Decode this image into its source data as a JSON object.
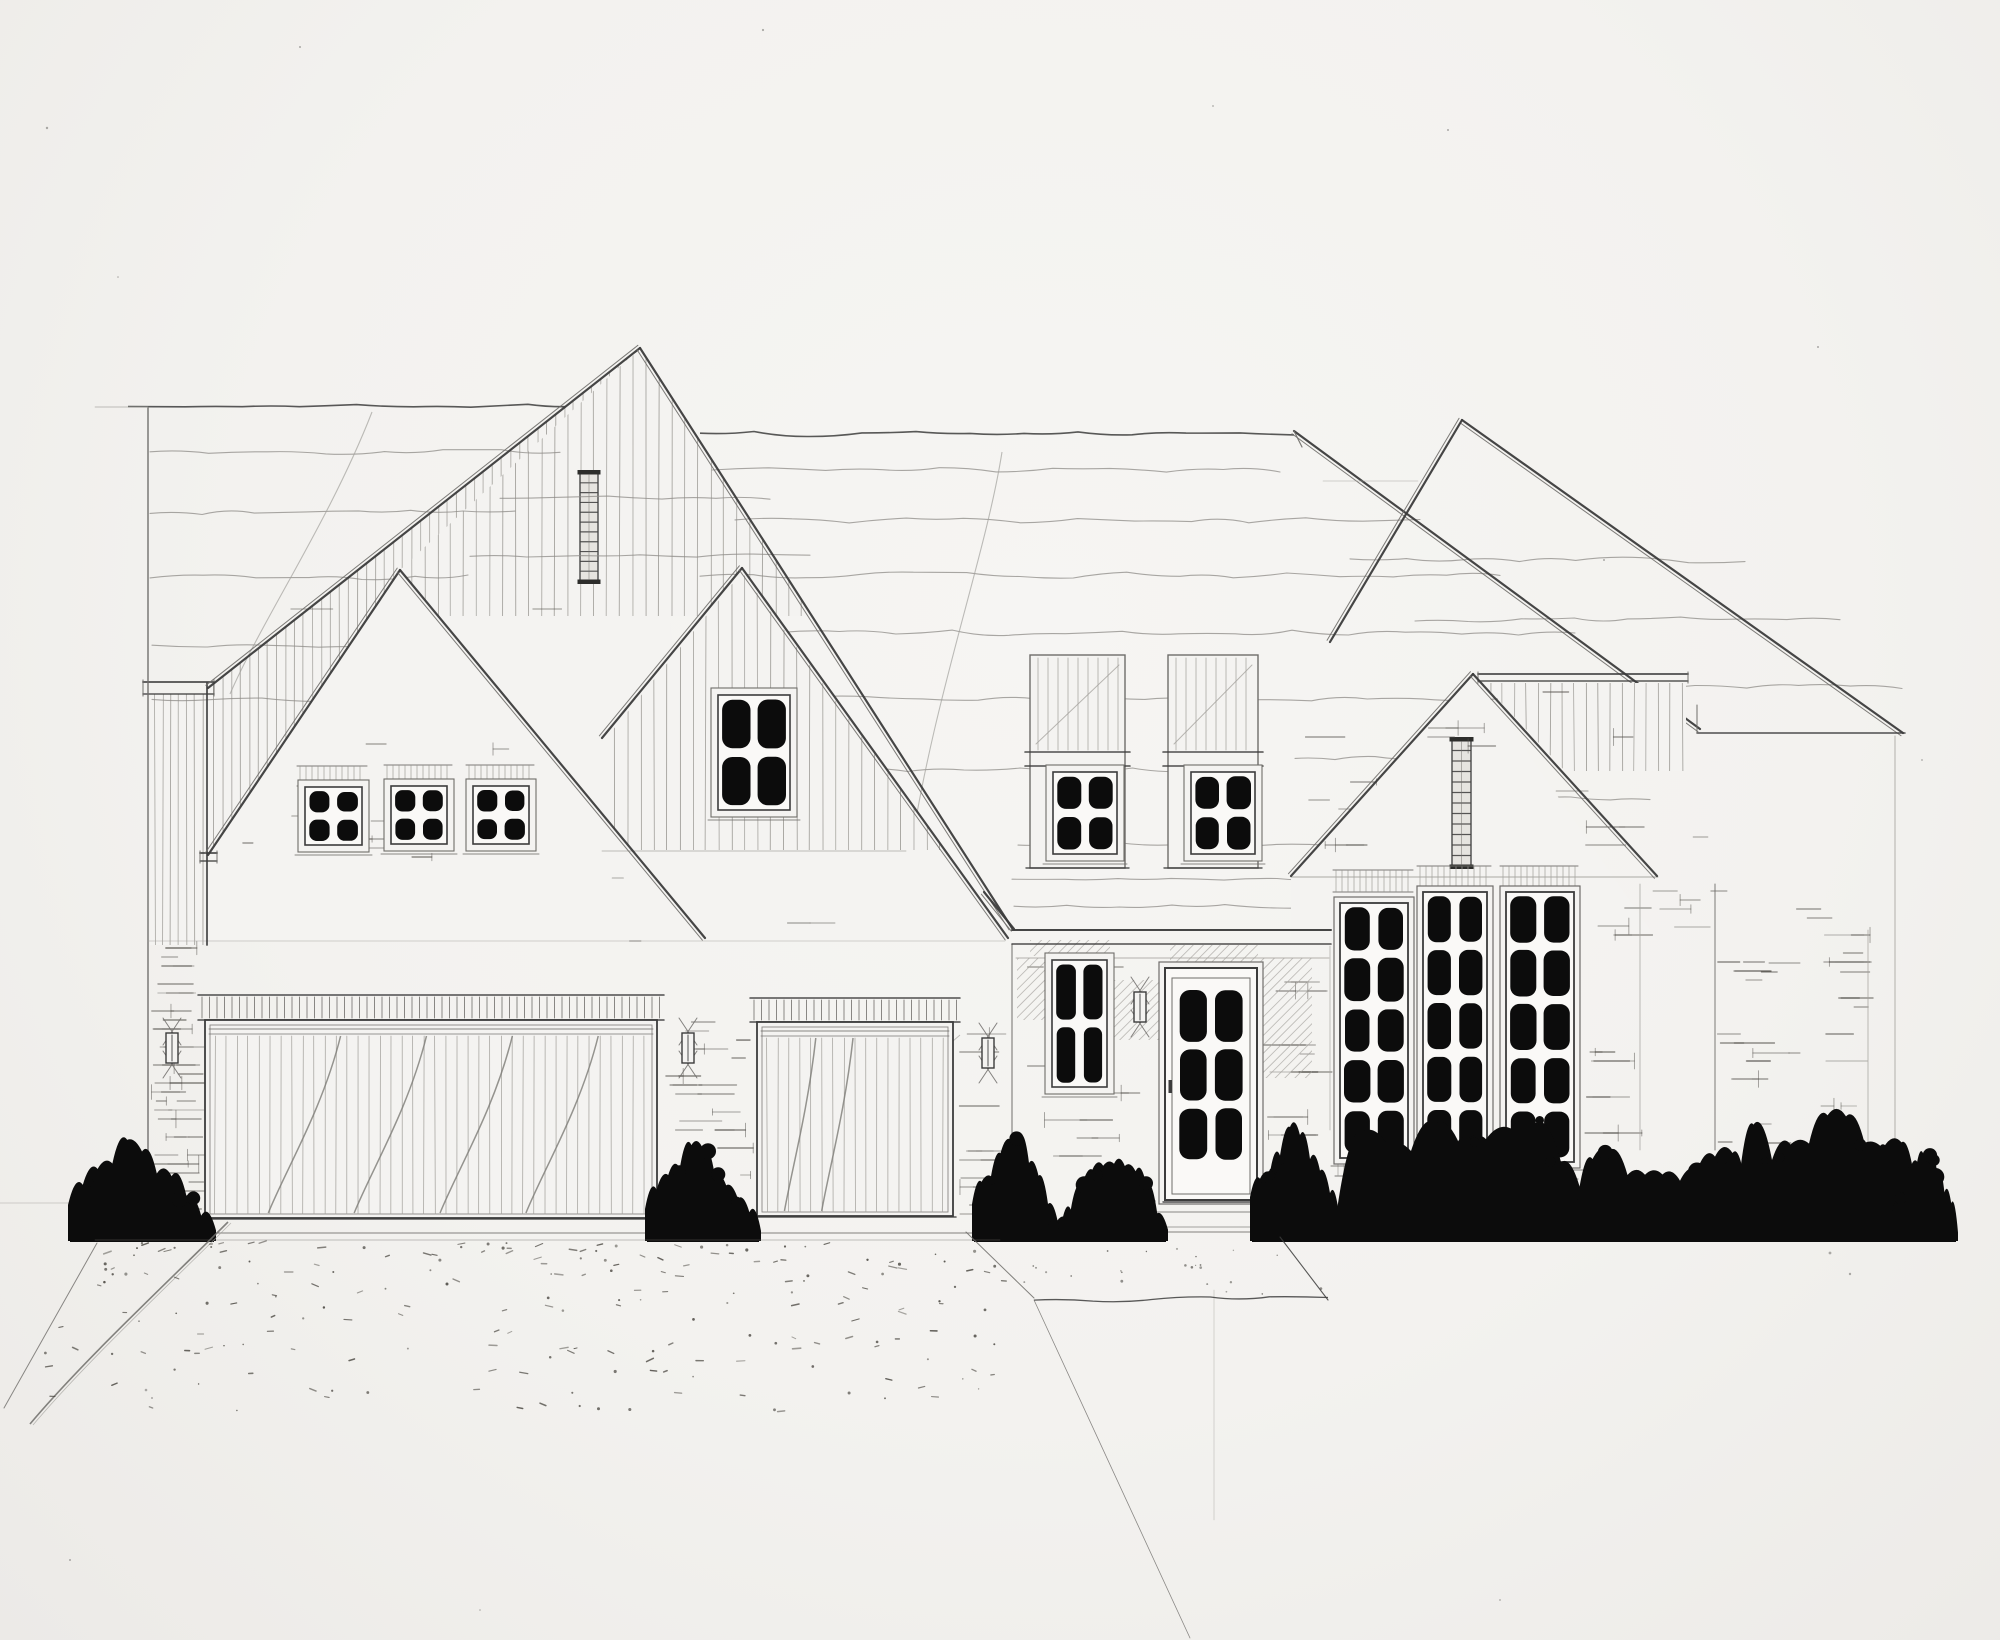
{
  "meta": {
    "kind": "hand-drawn pencil architectural front elevation sketch",
    "subject": "single-family house with overlapping steep gables, three-car garage, recessed entry, tall multi-pane windows, shrub row and stippled driveway",
    "width": 2000,
    "height": 1640
  },
  "palette": {
    "paper": "#f4f3f1",
    "paper_shade": "#eceae7",
    "dark": "#3c3c3c",
    "mid": "#6f6d6a",
    "light": "#a3a19c",
    "wave": "#8d8b87",
    "dash": "#56534e",
    "black": "#0c0c0c",
    "louver_fill": "#e6e4e0",
    "curve_gray": "#7c7a76"
  },
  "scene": {
    "ground": [
      [
        148,
        1233,
        1010,
        1233,
        1.0,
        "m"
      ],
      [
        1010,
        1232,
        1335,
        1232,
        1.0,
        "m"
      ]
    ],
    "ridges": [
      {
        "x1": 128,
        "x2": 585,
        "y": 406,
        "amp": 2
      },
      {
        "x1": 700,
        "x2": 1294,
        "y": 434,
        "amp": 2.5
      }
    ],
    "rakes": [
      [
        640,
        348,
        208,
        688
      ],
      [
        640,
        348,
        1012,
        928
      ],
      [
        742,
        568,
        602,
        738
      ],
      [
        742,
        568,
        1008,
        938
      ],
      [
        400,
        570,
        208,
        855
      ],
      [
        400,
        570,
        705,
        938
      ],
      [
        1473,
        674,
        1291,
        876
      ],
      [
        1473,
        674,
        1657,
        876
      ],
      [
        1294,
        431,
        1700,
        729
      ],
      [
        1462,
        420,
        1903,
        733
      ],
      [
        1462,
        420,
        1330,
        642
      ],
      [
        984,
        892,
        1014,
        929
      ]
    ],
    "edges": [
      [
        148,
        408,
        148,
        1232,
        1.5,
        "m"
      ],
      [
        95,
        407,
        148,
        407,
        0.7,
        "l"
      ],
      [
        148,
        941,
        1005,
        941,
        0.5,
        "l"
      ],
      [
        1697,
        733,
        1905,
        733,
        1.5,
        "d"
      ],
      [
        1895,
        736,
        1895,
        1208,
        0.9,
        "l"
      ],
      [
        1697,
        705,
        1697,
        733,
        1.1,
        "m"
      ],
      [
        1291,
        877,
        1658,
        877,
        0.9,
        "l"
      ],
      [
        1640,
        884,
        1640,
        1150,
        0.8,
        "l"
      ],
      [
        1715,
        884,
        1715,
        1150,
        1.0,
        "m"
      ],
      [
        1868,
        930,
        1868,
        1150,
        0.8,
        "l"
      ],
      [
        207,
        683,
        207,
        945,
        1.8,
        "d"
      ],
      [
        602,
        851,
        906,
        851,
        0.8,
        "l"
      ],
      [
        0,
        1203,
        95,
        1203,
        0.5,
        "l"
      ],
      [
        1214,
        1290,
        1214,
        1520,
        0.45,
        "l"
      ],
      [
        1294,
        431,
        1302,
        447,
        1.2,
        "m"
      ],
      [
        1323,
        481,
        1418,
        481,
        0.6,
        "l"
      ],
      [
        1012,
        944,
        1012,
        1232,
        1.1,
        "m"
      ],
      [
        1330,
        946,
        1330,
        1130,
        0.7,
        "l"
      ]
    ],
    "caps": [
      {
        "x1": 143,
        "x2": 214,
        "y": 682,
        "h": 12
      },
      {
        "x1": 200,
        "x2": 217,
        "y": 853,
        "h": 8
      },
      {
        "x1": 1478,
        "x2": 1688,
        "y": 674,
        "h": 7
      }
    ],
    "fascia": {
      "x1": 1012,
      "x2": 1331,
      "y": 930,
      "h": 14,
      "shadow_y": 958
    },
    "waves": [
      [
        150,
        560,
        452,
        3
      ],
      [
        150,
        515,
        512,
        3
      ],
      [
        150,
        468,
        577,
        3
      ],
      [
        152,
        430,
        646,
        2
      ],
      [
        152,
        372,
        700,
        2
      ],
      [
        500,
        770,
        498,
        2
      ],
      [
        470,
        810,
        556,
        2
      ],
      [
        712,
        1280,
        470,
        3
      ],
      [
        735,
        1420,
        520,
        3
      ],
      [
        700,
        1500,
        575,
        3
      ],
      [
        726,
        1575,
        633,
        3
      ],
      [
        756,
        1645,
        698,
        3
      ],
      [
        795,
        1245,
        770,
        3
      ],
      [
        1018,
        1328,
        845,
        2
      ],
      [
        1350,
        1745,
        560,
        3
      ],
      [
        1415,
        1840,
        620,
        3
      ],
      [
        1488,
        1902,
        687,
        3
      ],
      [
        1012,
        1330,
        879,
        2
      ],
      [
        1014,
        1330,
        906,
        2
      ],
      [
        1295,
        1455,
        758,
        2
      ],
      [
        1492,
        1650,
        798,
        2
      ]
    ],
    "curves": [
      {
        "d": "M1002,452 C985,560 932,700 908,868",
        "w": 1.1,
        "c": "light"
      },
      {
        "d": "M372,412 C330,520 262,620 230,694",
        "w": 1.1,
        "c": "light"
      },
      {
        "d": "M960,1035 C930,1060 900,1100 892,1130",
        "w": 0.9,
        "c": "light"
      }
    ],
    "boards": [
      {
        "poly": [
          [
            640,
            350
          ],
          [
            300,
            616
          ],
          [
            812,
            616
          ]
        ],
        "sp": 13
      },
      {
        "poly": [
          [
            208,
            853
          ],
          [
            400,
            570
          ],
          [
            640,
            348
          ],
          [
            208,
            688
          ]
        ],
        "sp": 9
      },
      {
        "poly": [
          [
            150,
            694
          ],
          [
            205,
            694
          ],
          [
            205,
            945
          ],
          [
            150,
            945
          ]
        ],
        "sp": 8
      },
      {
        "poly": [
          [
            742,
            572
          ],
          [
            607,
            737
          ],
          [
            607,
            850
          ],
          [
            944,
            850
          ]
        ],
        "sp": 13
      },
      {
        "poly": [
          [
            1483,
            683
          ],
          [
            1686,
            683
          ],
          [
            1686,
            771
          ],
          [
            1565,
            771
          ]
        ],
        "sp": 12
      }
    ],
    "gable_fills": [
      [
        [
          640,
          348
        ],
        [
          208,
          688
        ],
        [
          208,
          940
        ],
        [
          705,
          940
        ]
      ],
      [
        [
          742,
          568
        ],
        [
          602,
          738
        ],
        [
          602,
          940
        ],
        [
          1008,
          940
        ]
      ],
      [
        [
          400,
          570
        ],
        [
          208,
          855
        ],
        [
          208,
          940
        ],
        [
          705,
          940
        ]
      ],
      [
        [
          1473,
          674
        ],
        [
          1291,
          876
        ],
        [
          1291,
          940
        ],
        [
          1657,
          940
        ]
      ]
    ],
    "louvers": [
      {
        "x": 580,
        "y": 473,
        "w": 18,
        "h": 108,
        "rungs": 10
      },
      {
        "x": 1452,
        "y": 740,
        "w": 19,
        "h": 126,
        "rungs": 11
      }
    ],
    "bricks": [
      [
        230,
        600,
        440,
        330,
        0.13,
        12
      ],
      [
        290,
        740,
        260,
        120,
        0.35,
        27
      ],
      [
        150,
        948,
        58,
        282,
        0.85,
        11
      ],
      [
        215,
        950,
        440,
        45,
        0.18,
        28
      ],
      [
        610,
        860,
        330,
        130,
        0.22,
        13
      ],
      [
        660,
        1022,
        94,
        190,
        0.5,
        15
      ],
      [
        958,
        1025,
        50,
        190,
        0.45,
        16
      ],
      [
        1016,
        958,
        148,
        268,
        0.26,
        17
      ],
      [
        1260,
        955,
        72,
        270,
        0.35,
        18
      ],
      [
        1305,
        692,
        340,
        180,
        0.2,
        19
      ],
      [
        1294,
        800,
        80,
        70,
        0.4,
        29
      ],
      [
        1580,
        800,
        70,
        70,
        0.4,
        30
      ],
      [
        1335,
        1158,
        250,
        60,
        0.3,
        20
      ],
      [
        1584,
        890,
        72,
        250,
        0.3,
        21
      ],
      [
        1652,
        756,
        240,
        394,
        0.2,
        22
      ],
      [
        1715,
        935,
        60,
        210,
        0.45,
        31
      ],
      [
        1820,
        935,
        55,
        210,
        0.4,
        32
      ],
      [
        1032,
        768,
        92,
        98,
        0.45,
        23
      ],
      [
        1170,
        768,
        88,
        98,
        0.45,
        24
      ]
    ],
    "diag_hatch": [
      [
        1017,
        958,
        46,
        62
      ],
      [
        1112,
        980,
        48,
        60
      ],
      [
        1258,
        958,
        54,
        120
      ],
      [
        1170,
        945,
        88,
        20
      ],
      [
        1030,
        940,
        80,
        16
      ]
    ],
    "soldiers": [
      [
        297,
        766,
        70,
        20
      ],
      [
        384,
        765,
        68,
        20
      ],
      [
        466,
        765,
        68,
        20
      ],
      [
        1333,
        870,
        80,
        22
      ],
      [
        1417,
        866,
        74,
        22
      ],
      [
        1500,
        866,
        78,
        22
      ],
      [
        1335,
        1158,
        78,
        18
      ],
      [
        1419,
        1159,
        72,
        18
      ],
      [
        1502,
        1161,
        76,
        18
      ]
    ],
    "windows_small": [
      {
        "x": 305,
        "y": 787,
        "w": 57,
        "h": 58
      },
      {
        "x": 391,
        "y": 786,
        "w": 56,
        "h": 58
      },
      {
        "x": 473,
        "y": 786,
        "w": 56,
        "h": 58
      },
      {
        "x": 718,
        "y": 695,
        "w": 72,
        "h": 115
      },
      {
        "x": 1053,
        "y": 772,
        "w": 64,
        "h": 82
      },
      {
        "x": 1191,
        "y": 772,
        "w": 64,
        "h": 82
      },
      {
        "x": 1052,
        "y": 960,
        "w": 55,
        "h": 127
      }
    ],
    "tall_windows": [
      {
        "x": 1340,
        "y": 903,
        "w": 68,
        "h": 255
      },
      {
        "x": 1423,
        "y": 892,
        "w": 64,
        "h": 268
      },
      {
        "x": 1506,
        "y": 892,
        "w": 68,
        "h": 270
      }
    ],
    "front_door": {
      "x": 1165,
      "y": 968,
      "w": 92,
      "h": 232
    },
    "garage_doors": [
      {
        "x": 205,
        "y": 1020,
        "w": 452,
        "h": 198,
        "curves": 4,
        "header": [
          198,
          995,
          466,
          25
        ]
      },
      {
        "x": 757,
        "y": 1022,
        "w": 196,
        "h": 194,
        "curves": 2,
        "header": [
          750,
          998,
          210,
          24
        ]
      }
    ],
    "sconces": [
      [
        172,
        1048
      ],
      [
        688,
        1048
      ],
      [
        988,
        1053
      ],
      [
        1140,
        1007
      ]
    ],
    "piers": {
      "list": [
        [
          1030,
          95
        ],
        [
          1168,
          90
        ]
      ],
      "top": 655,
      "cap_y": 752,
      "cap_h": 14,
      "bottom": 868
    },
    "bushes": [
      {
        "x": 68,
        "w": 148,
        "h": 106,
        "shape": "cone",
        "seed": 31
      },
      {
        "x": 645,
        "w": 116,
        "h": 100,
        "shape": "cone",
        "seed": 33
      },
      {
        "x": 972,
        "w": 95,
        "h": 112,
        "shape": "cone",
        "seed": 34
      },
      {
        "x": 1060,
        "w": 108,
        "h": 80,
        "shape": "round",
        "seed": 35
      },
      {
        "x": 1250,
        "w": 100,
        "h": 114,
        "shape": "cone",
        "seed": 36
      },
      {
        "x": 1336,
        "w": 250,
        "h": 118,
        "shape": "hedge",
        "seed": 37
      },
      {
        "x": 1575,
        "w": 175,
        "h": 95,
        "shape": "hedge",
        "seed": 38
      },
      {
        "x": 1735,
        "w": 185,
        "h": 130,
        "shape": "hedge",
        "seed": 39
      },
      {
        "x": 1890,
        "w": 68,
        "h": 85,
        "shape": "round",
        "seed": 40
      }
    ],
    "bush_base": 1241,
    "steps": [
      [
        1152,
        1212,
        1270,
        1212,
        0.9
      ],
      [
        1146,
        1227,
        1277,
        1227,
        0.8
      ]
    ],
    "walk": {
      "left": [
        966,
        1232,
        1034,
        1298
      ],
      "right": [
        1280,
        1237,
        1328,
        1300
      ],
      "bottom": {
        "x1": 1034,
        "x2": 1328,
        "y": 1299,
        "amp": 3
      }
    },
    "drive": {
      "lines": [
        [
          97,
          1243,
          4,
          1408,
          1.0
        ],
        [
          1034,
          1300,
          1190,
          1638,
          0.8
        ],
        [
          95,
          1240,
          1000,
          1240,
          0.5
        ]
      ],
      "curve": "M228,1222 C168,1282 84,1360 30,1424",
      "stipple": {
        "seed": 7,
        "count": 215,
        "x1": 40,
        "x2": 1008,
        "y1": 1243,
        "y2": 1412
      },
      "walk_dots": {
        "seed": 8,
        "count": 24,
        "x1": 1024,
        "x2": 1326,
        "y1": 1246,
        "y2": 1294
      }
    },
    "specks": [
      [
        47,
        128,
        1.2
      ],
      [
        300,
        47,
        1.0
      ],
      [
        763,
        30,
        1.1
      ],
      [
        1213,
        106,
        0.9
      ],
      [
        1448,
        130,
        1.0
      ],
      [
        1604,
        560,
        1.0
      ],
      [
        118,
        277,
        0.8
      ],
      [
        1818,
        347,
        1.0
      ],
      [
        1922,
        760,
        0.9
      ],
      [
        70,
        1560,
        1.0
      ],
      [
        480,
        1610,
        0.8
      ],
      [
        1500,
        1600,
        0.9
      ],
      [
        1830,
        1253,
        1.4
      ],
      [
        1850,
        1274,
        1.2
      ],
      [
        146,
        1390,
        1.3
      ],
      [
        152,
        1398,
        1.0
      ]
    ]
  }
}
